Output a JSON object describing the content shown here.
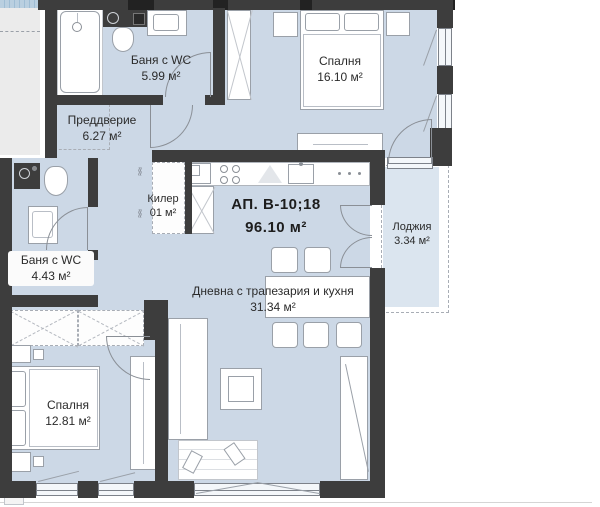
{
  "plan": {
    "title": {
      "line1": "АП. В-10;18",
      "line2": "96.10 м²"
    },
    "rooms": {
      "bath1": {
        "name": "Баня с WC",
        "area": "5.99 м²"
      },
      "bedroom1": {
        "name": "Спалня",
        "area": "16.10 м²"
      },
      "hallway": {
        "name": "Преддверие",
        "area": "6.27 м²"
      },
      "closet": {
        "name": "Килер",
        "area": "01 м²"
      },
      "loggia": {
        "name": "Лоджия",
        "area": "3.34 м²"
      },
      "bath2": {
        "name": "Баня с WC",
        "area": "4.43 м²"
      },
      "living": {
        "name": "Дневна с трапезария и кухня",
        "area": "31.34 м²"
      },
      "bedroom2": {
        "name": "Спалня",
        "area": "12.81 м²"
      }
    },
    "colors": {
      "wall": "#3d3d3d",
      "room": "#ccd8e6",
      "loggia": "#dbe5ef",
      "adjacent": "#ebebeb",
      "accent_strip": "#b9cfe0"
    }
  }
}
